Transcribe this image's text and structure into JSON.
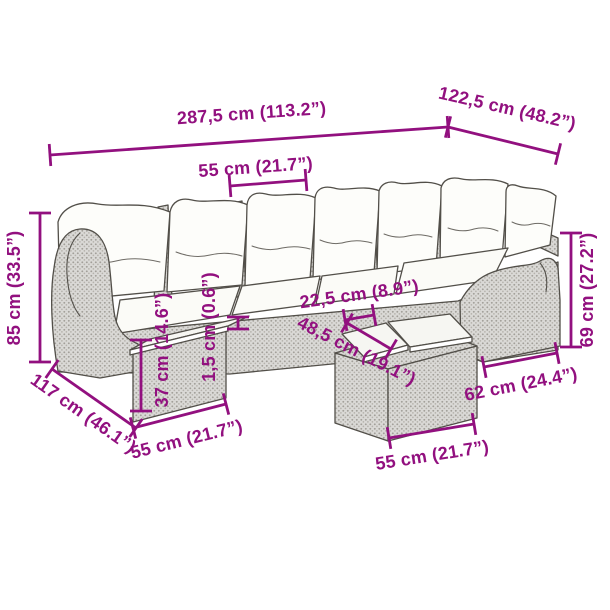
{
  "page": {
    "background": "#ffffff",
    "description": "Dimension diagram of an 8-piece grey poly rattan garden corner sofa set with cream cushions, side table with 1,5 cm top, and ottoman tables"
  },
  "illustration": {
    "frame_color": "#dad9d6",
    "weave_dot_color": "#a29f99",
    "outline_color": "#524f49",
    "cushion_color": "#fdfdfa",
    "tabletop_color": "#f6f6f2"
  },
  "annotation": {
    "color": "#92107f",
    "stroke_width": 2.8,
    "tick_half": 11,
    "dimensions": [
      {
        "id": "overall-width",
        "label": "287,5 cm (113.2”)",
        "line": {
          "x1": 50,
          "y1": 155,
          "x2": 448,
          "y2": 127
        },
        "text": {
          "x": 252,
          "y": 119,
          "rotate": -4
        }
      },
      {
        "id": "return-width",
        "label": "122,5 cm (48.2”)",
        "line": {
          "x1": 448,
          "y1": 127,
          "x2": 558,
          "y2": 154
        },
        "text": {
          "x": 506,
          "y": 114,
          "rotate": 13
        }
      },
      {
        "id": "seat-width",
        "label": "55 cm (21.7”)",
        "line": {
          "x1": 230,
          "y1": 186,
          "x2": 306,
          "y2": 180
        },
        "text": {
          "x": 256,
          "y": 173,
          "rotate": -4
        }
      },
      {
        "id": "overall-height",
        "label": "85 cm (33.5”)",
        "line": {
          "x1": 40,
          "y1": 213,
          "x2": 40,
          "y2": 362
        },
        "text": {
          "x": 20,
          "y": 288,
          "rotate": -90
        }
      },
      {
        "id": "depth",
        "label": "117 cm (46.1”)",
        "line": {
          "x1": 52,
          "y1": 369,
          "x2": 136,
          "y2": 428
        },
        "text": {
          "x": 80,
          "y": 418,
          "rotate": 35
        }
      },
      {
        "id": "table-width",
        "label": "55 cm (21.7”)",
        "line": {
          "x1": 133,
          "y1": 428,
          "x2": 226,
          "y2": 404
        },
        "text": {
          "x": 188,
          "y": 445,
          "rotate": -14
        }
      },
      {
        "id": "table-height",
        "label": "37 cm (14.6”)",
        "line": {
          "x1": 141,
          "y1": 340,
          "x2": 141,
          "y2": 411
        },
        "text": {
          "x": 168,
          "y": 350,
          "rotate": -90
        }
      },
      {
        "id": "top-thickness",
        "label": "1,5 cm (0.6”)",
        "line": {
          "x1": 238,
          "y1": 317,
          "x2": 238,
          "y2": 329
        },
        "text": {
          "x": 215,
          "y": 327,
          "rotate": -90
        }
      },
      {
        "id": "gap-width",
        "label": "22,5 cm (8.9”)",
        "line": {
          "x1": 345,
          "y1": 320,
          "x2": 374,
          "y2": 315
        },
        "text": {
          "x": 360,
          "y": 300,
          "rotate": -8
        }
      },
      {
        "id": "tabletop-width",
        "label": "48,5 cm (19.1”)",
        "line": {
          "x1": 347,
          "y1": 323,
          "x2": 391,
          "y2": 349
        },
        "text": {
          "x": 354,
          "y": 356,
          "rotate": 27
        }
      },
      {
        "id": "arm-height",
        "label": "69 cm (27.2”)",
        "line": {
          "x1": 571,
          "y1": 233,
          "x2": 571,
          "y2": 347
        },
        "text": {
          "x": 593,
          "y": 290,
          "rotate": -90
        }
      },
      {
        "id": "arm-width",
        "label": "62 cm (24.4”)",
        "line": {
          "x1": 484,
          "y1": 367,
          "x2": 557,
          "y2": 353
        },
        "text": {
          "x": 522,
          "y": 390,
          "rotate": -11
        }
      },
      {
        "id": "ottoman-width",
        "label": "55 cm (21.7”)",
        "line": {
          "x1": 389,
          "y1": 438,
          "x2": 474,
          "y2": 424
        },
        "text": {
          "x": 433,
          "y": 461,
          "rotate": -9
        }
      }
    ]
  }
}
